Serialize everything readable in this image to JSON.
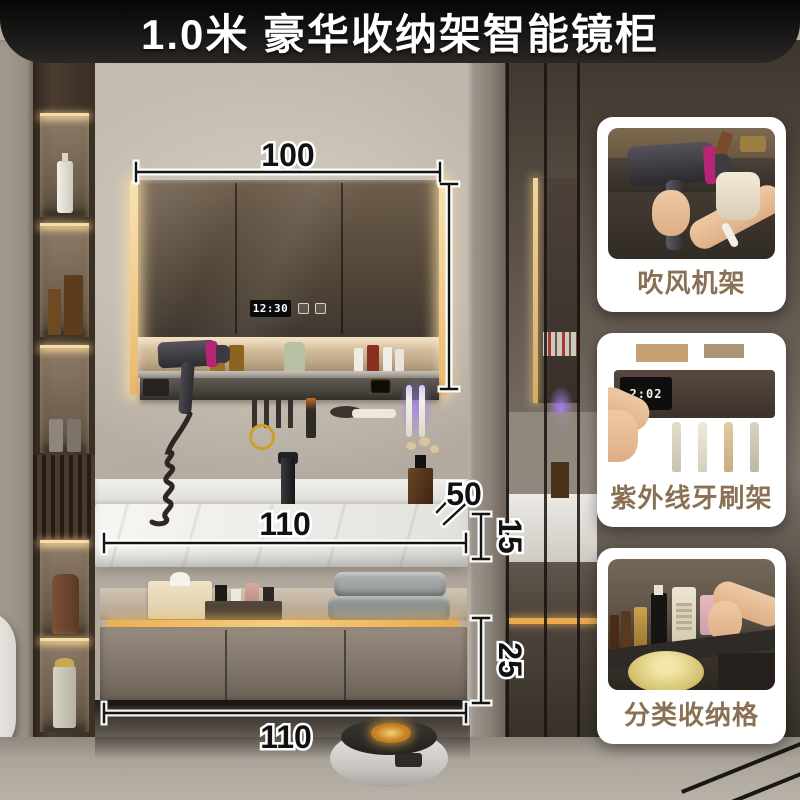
{
  "banner": {
    "title": "1.0米 豪华收纳架智能镜柜"
  },
  "annotations": {
    "mirror_width": "100",
    "countertop_width": "110",
    "countertop_depth": "50",
    "countertop_thickness": "15",
    "cabinet_height": "25",
    "cabinet_width": "110"
  },
  "mirror_display": {
    "time": "12:30",
    "icons": [
      "defog-icon",
      "light-icon"
    ]
  },
  "feature_cards": [
    {
      "label": "吹风机架"
    },
    {
      "label": "紫外线牙刷架",
      "device_time": "2:02"
    },
    {
      "label": "分类收纳格"
    }
  ],
  "colors": {
    "banner_bg": "#111111",
    "banner_text": "#ffffff",
    "led_warm": "#f3cd8e",
    "cabinet_led": "#f8cd7d",
    "uv_glow": "#9b6ef3",
    "card_bg": "#ffffff",
    "card_label_text": "#8a7055",
    "annotation_text": "#111111"
  }
}
